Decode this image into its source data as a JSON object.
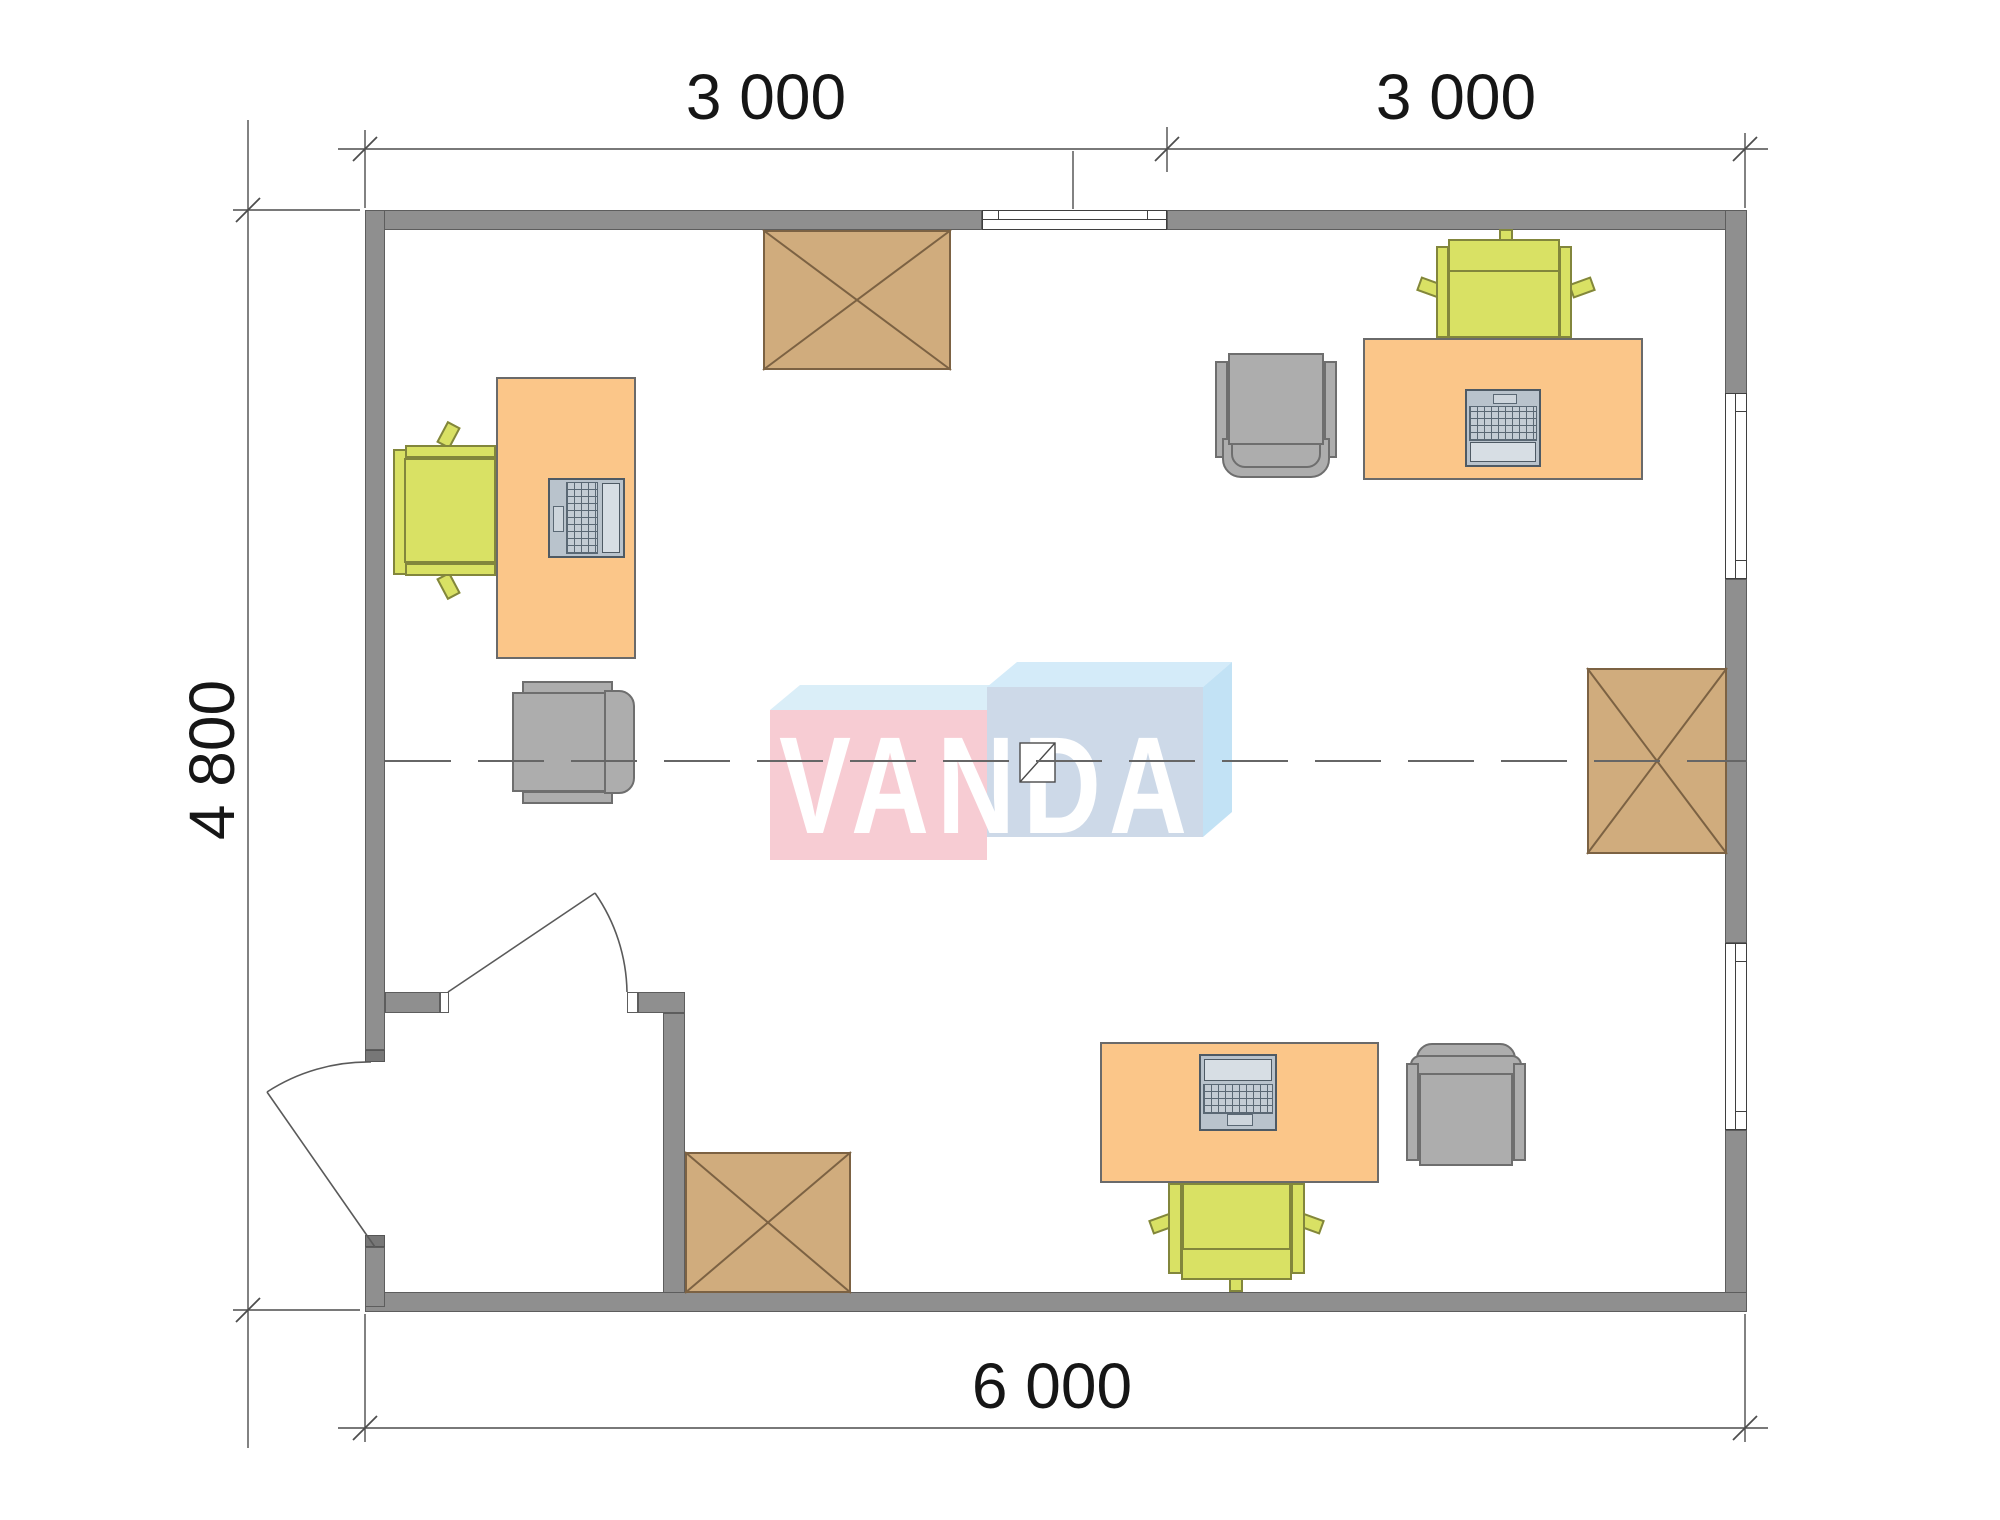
{
  "dimensions": {
    "top_left": "3 000",
    "top_right": "3 000",
    "side": "4 800",
    "bottom": "6 000"
  },
  "watermark": {
    "text": "VANDA"
  },
  "colors": {
    "wall": "#8f8f8f",
    "wall_edge": "#5d5d5d",
    "desk": "#fbc689",
    "desk_edge": "#6a6a6a",
    "crate": "#d0ac7d",
    "crate_edge": "#7c6243",
    "chair_green": "#d9e164",
    "chair_green_edge": "#82863c",
    "chair_gray": "#adadad",
    "chair_gray_edge": "#6e6e6e",
    "laptop_base": "#b9c3cc",
    "laptop_screen": "#d7dee4",
    "laptop_edge": "#4e5a64",
    "dim_line": "#4d4d4d",
    "centerline": "#666666",
    "logo_pink": "#f7ccd3",
    "logo_blue_front": "#cdd9e8",
    "logo_top_left": "#daeef8",
    "logo_top_right": "#d4ebf9",
    "logo_side": "#c2e2f5",
    "logo_letters": "#ffffff"
  },
  "furniture": [
    {
      "name": "desk-with-laptop",
      "area": "left"
    },
    {
      "name": "office-chair",
      "area": "left"
    },
    {
      "name": "visitor-chair",
      "area": "left"
    },
    {
      "name": "desk-with-laptop",
      "area": "top-right"
    },
    {
      "name": "office-chair",
      "area": "top-right"
    },
    {
      "name": "visitor-armchair",
      "area": "top-right"
    },
    {
      "name": "desk-with-laptop",
      "area": "bottom"
    },
    {
      "name": "office-chair",
      "area": "bottom"
    },
    {
      "name": "visitor-armchair",
      "area": "bottom"
    },
    {
      "name": "storage-box",
      "area": "top"
    },
    {
      "name": "storage-box",
      "area": "right"
    },
    {
      "name": "storage-box",
      "area": "bottom-left"
    }
  ],
  "openings": {
    "entrance_door": "bottom-left exterior, opens outward",
    "interior_door": "vestibule to office, opens inward",
    "windows": 3
  }
}
